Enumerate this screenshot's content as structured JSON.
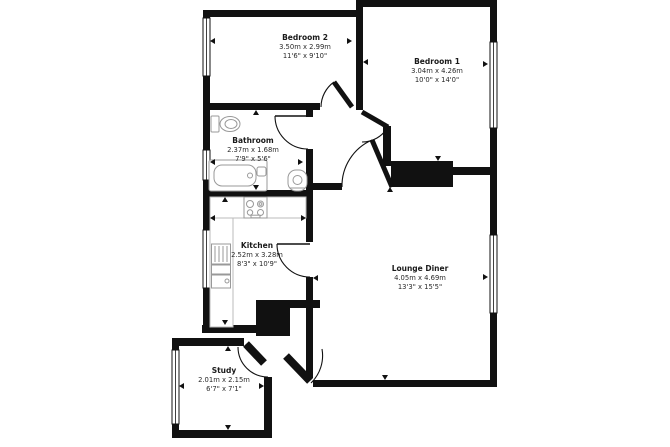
{
  "plan": {
    "type": "floor-plan",
    "rooms": [
      {
        "id": "bedroom2",
        "name": "Bedroom 2",
        "metric": "3.50m x 2.99m",
        "imperial": "11'6\" x 9'10\""
      },
      {
        "id": "bedroom1",
        "name": "Bedroom 1",
        "metric": "3.04m x 4.26m",
        "imperial": "10'0\" x 14'0\""
      },
      {
        "id": "bathroom",
        "name": "Bathroom",
        "metric": "2.37m x 1.68m",
        "imperial": "7'9\" x 5'6\""
      },
      {
        "id": "kitchen",
        "name": "Kitchen",
        "metric": "2.52m x 3.28m",
        "imperial": "8'3\" x 10'9\""
      },
      {
        "id": "lounge",
        "name": "Lounge Diner",
        "metric": "4.05m x 4.69m",
        "imperial": "13'3\" x 15'5\""
      },
      {
        "id": "study",
        "name": "Study",
        "metric": "2.01m x 2.15m",
        "imperial": "6'7\" x 7'1\""
      }
    ],
    "fixtures": [
      "toilet-icon",
      "bathtub-icon",
      "basin-icon",
      "hob-icon",
      "kitchen-sink-icon"
    ],
    "colors": {
      "wall": "#111111",
      "fixture": "#999999",
      "text": "#1a1a1a",
      "background": "#ffffff"
    }
  }
}
